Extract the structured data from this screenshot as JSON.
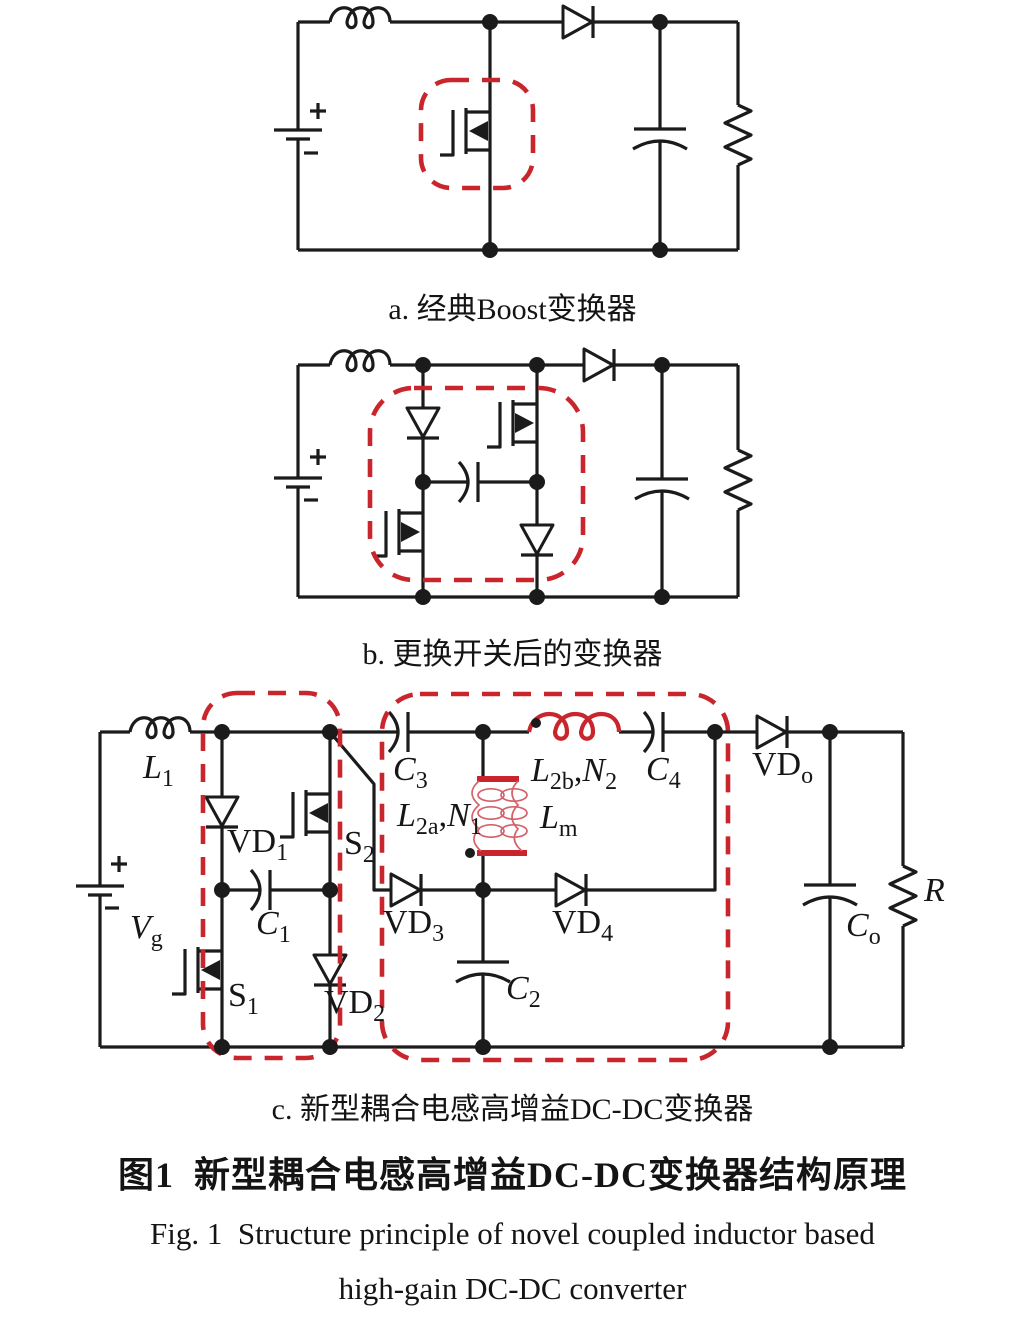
{
  "captions": {
    "a": "a. 经典Boost变换器",
    "b": "b. 更换开关后的变换器",
    "c": "c. 新型耦合电感高增益DC-DC变换器",
    "title_zh": "图1  新型耦合电感高增益DC-DC变换器结构原理",
    "title_en_line1": "Fig. 1  Structure principle of novel coupled inductor based",
    "title_en_line2": "high-gain DC-DC converter"
  },
  "colors": {
    "wire": "#1b1b1b",
    "highlight_red": "#c9252d"
  },
  "labels": {
    "L1": {
      "main": "L",
      "sub": "1"
    },
    "Vg": {
      "main": "V",
      "sub": "g"
    },
    "VD1": {
      "main": "VD",
      "sub": "1"
    },
    "S1": {
      "main": "S",
      "sub": "1"
    },
    "S2": {
      "main": "S",
      "sub": "2"
    },
    "C1": {
      "main": "C",
      "sub": "1"
    },
    "VD2": {
      "main": "VD",
      "sub": "2"
    },
    "C3": {
      "main": "C",
      "sub": "3"
    },
    "L2a": {
      "main": "L",
      "sub": "2a"
    },
    "N1": {
      "main": "N",
      "sub": "1"
    },
    "comma": ",",
    "L2b": {
      "main": "L",
      "sub": "2b"
    },
    "N2": {
      "main": "N",
      "sub": "2"
    },
    "Lm": {
      "main": "L",
      "sub": "m"
    },
    "C4": {
      "main": "C",
      "sub": "4"
    },
    "VD3": {
      "main": "VD",
      "sub": "3"
    },
    "VD4": {
      "main": "VD",
      "sub": "4"
    },
    "C2": {
      "main": "C",
      "sub": "2"
    },
    "VDo": {
      "main": "VD",
      "sub": "o"
    },
    "Co": {
      "main": "C",
      "sub": "o"
    },
    "R": {
      "main": "R"
    }
  }
}
